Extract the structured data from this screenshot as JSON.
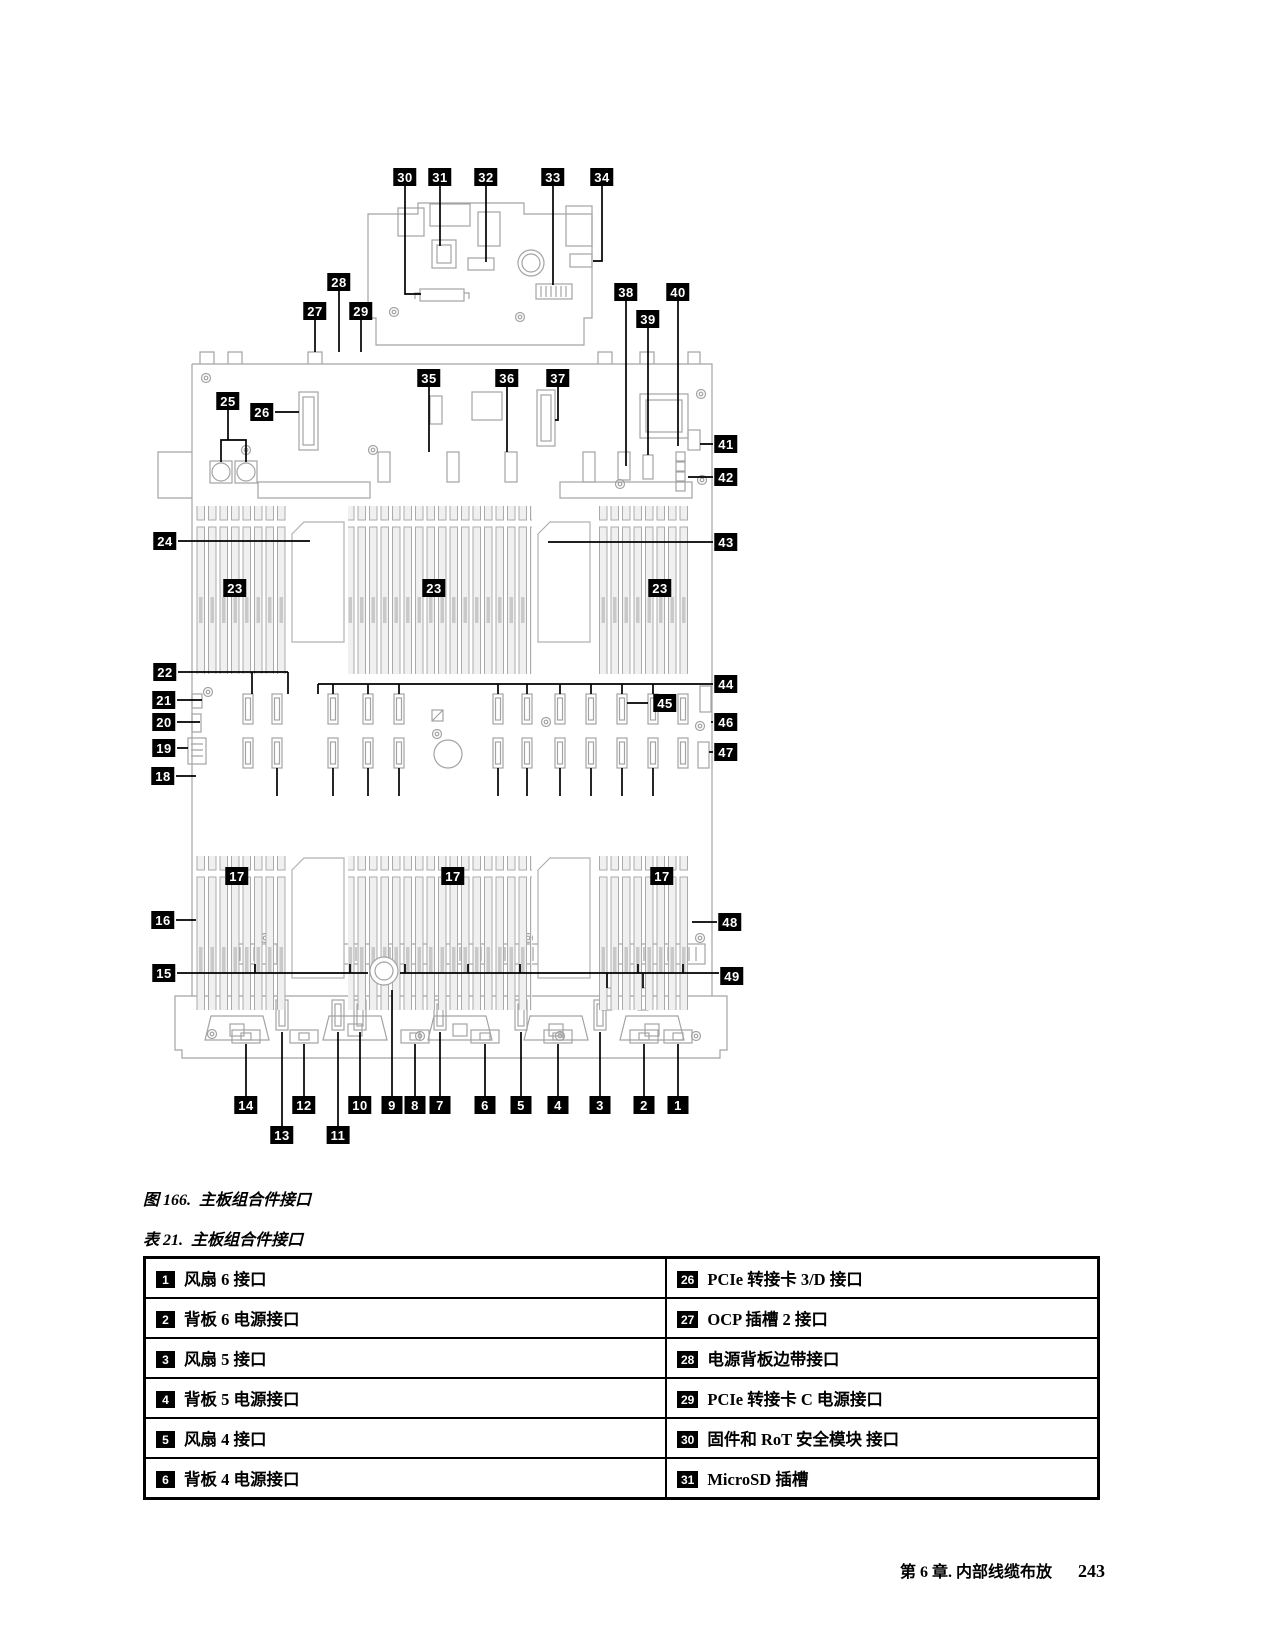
{
  "figure": {
    "caption_prefix": "图 166.",
    "caption_text": "主板组合件接口",
    "callouts": [
      {
        "n": "30",
        "x": 405,
        "y": 177
      },
      {
        "n": "31",
        "x": 440,
        "y": 177
      },
      {
        "n": "32",
        "x": 486,
        "y": 177
      },
      {
        "n": "33",
        "x": 553,
        "y": 177
      },
      {
        "n": "34",
        "x": 602,
        "y": 177
      },
      {
        "n": "28",
        "x": 339,
        "y": 282
      },
      {
        "n": "27",
        "x": 315,
        "y": 311
      },
      {
        "n": "29",
        "x": 361,
        "y": 311
      },
      {
        "n": "38",
        "x": 626,
        "y": 292
      },
      {
        "n": "40",
        "x": 678,
        "y": 292
      },
      {
        "n": "39",
        "x": 648,
        "y": 319
      },
      {
        "n": "25",
        "x": 228,
        "y": 401
      },
      {
        "n": "26",
        "x": 262,
        "y": 412
      },
      {
        "n": "35",
        "x": 429,
        "y": 378
      },
      {
        "n": "36",
        "x": 507,
        "y": 378
      },
      {
        "n": "37",
        "x": 558,
        "y": 378
      },
      {
        "n": "41",
        "x": 726,
        "y": 444
      },
      {
        "n": "42",
        "x": 726,
        "y": 477
      },
      {
        "n": "24",
        "x": 165,
        "y": 541
      },
      {
        "n": "43",
        "x": 726,
        "y": 542
      },
      {
        "n": "23",
        "x": 235,
        "y": 588
      },
      {
        "n": "23",
        "x": 434,
        "y": 588
      },
      {
        "n": "23",
        "x": 660,
        "y": 588
      },
      {
        "n": "22",
        "x": 165,
        "y": 672
      },
      {
        "n": "44",
        "x": 726,
        "y": 684
      },
      {
        "n": "21",
        "x": 164,
        "y": 700
      },
      {
        "n": "45",
        "x": 665,
        "y": 703
      },
      {
        "n": "20",
        "x": 164,
        "y": 722
      },
      {
        "n": "46",
        "x": 726,
        "y": 722
      },
      {
        "n": "19",
        "x": 164,
        "y": 748
      },
      {
        "n": "47",
        "x": 726,
        "y": 752
      },
      {
        "n": "18",
        "x": 163,
        "y": 776
      },
      {
        "n": "17",
        "x": 237,
        "y": 876
      },
      {
        "n": "17",
        "x": 453,
        "y": 876
      },
      {
        "n": "17",
        "x": 662,
        "y": 876
      },
      {
        "n": "16",
        "x": 163,
        "y": 920
      },
      {
        "n": "48",
        "x": 730,
        "y": 922
      },
      {
        "n": "15",
        "x": 164,
        "y": 973
      },
      {
        "n": "49",
        "x": 732,
        "y": 976
      },
      {
        "n": "14",
        "x": 246,
        "y": 1105
      },
      {
        "n": "12",
        "x": 304,
        "y": 1105
      },
      {
        "n": "10",
        "x": 360,
        "y": 1105
      },
      {
        "n": "9",
        "x": 392,
        "y": 1105
      },
      {
        "n": "8",
        "x": 415,
        "y": 1105
      },
      {
        "n": "7",
        "x": 440,
        "y": 1105
      },
      {
        "n": "6",
        "x": 485,
        "y": 1105
      },
      {
        "n": "5",
        "x": 521,
        "y": 1105
      },
      {
        "n": "4",
        "x": 558,
        "y": 1105
      },
      {
        "n": "3",
        "x": 600,
        "y": 1105
      },
      {
        "n": "2",
        "x": 644,
        "y": 1105
      },
      {
        "n": "1",
        "x": 678,
        "y": 1105
      },
      {
        "n": "13",
        "x": 282,
        "y": 1135
      },
      {
        "n": "11",
        "x": 338,
        "y": 1135
      }
    ]
  },
  "table": {
    "caption_prefix": "表 21.",
    "caption_text": "主板组合件接口",
    "rows": [
      {
        "l_n": "1",
        "l": "风扇 6 接口",
        "r_n": "26",
        "r": "PCIe 转接卡 3/D 接口"
      },
      {
        "l_n": "2",
        "l": "背板 6 电源接口",
        "r_n": "27",
        "r": "OCP 插槽 2 接口"
      },
      {
        "l_n": "3",
        "l": "风扇 5 接口",
        "r_n": "28",
        "r": "电源背板边带接口"
      },
      {
        "l_n": "4",
        "l": "背板 5 电源接口",
        "r_n": "29",
        "r": "PCIe 转接卡 C 电源接口"
      },
      {
        "l_n": "5",
        "l": "风扇 4 接口",
        "r_n": "30",
        "r": "固件和 RoT 安全模块 接口"
      },
      {
        "l_n": "6",
        "l": "背板 4 电源接口",
        "r_n": "31",
        "r": "MicroSD 插槽"
      }
    ]
  },
  "footer": {
    "chapter": "第 6 章. 内部线缆布放",
    "page": "243"
  },
  "colors": {
    "line_art": "#a3a3a3",
    "callout_bg": "#000000",
    "callout_fg": "#ffffff"
  }
}
